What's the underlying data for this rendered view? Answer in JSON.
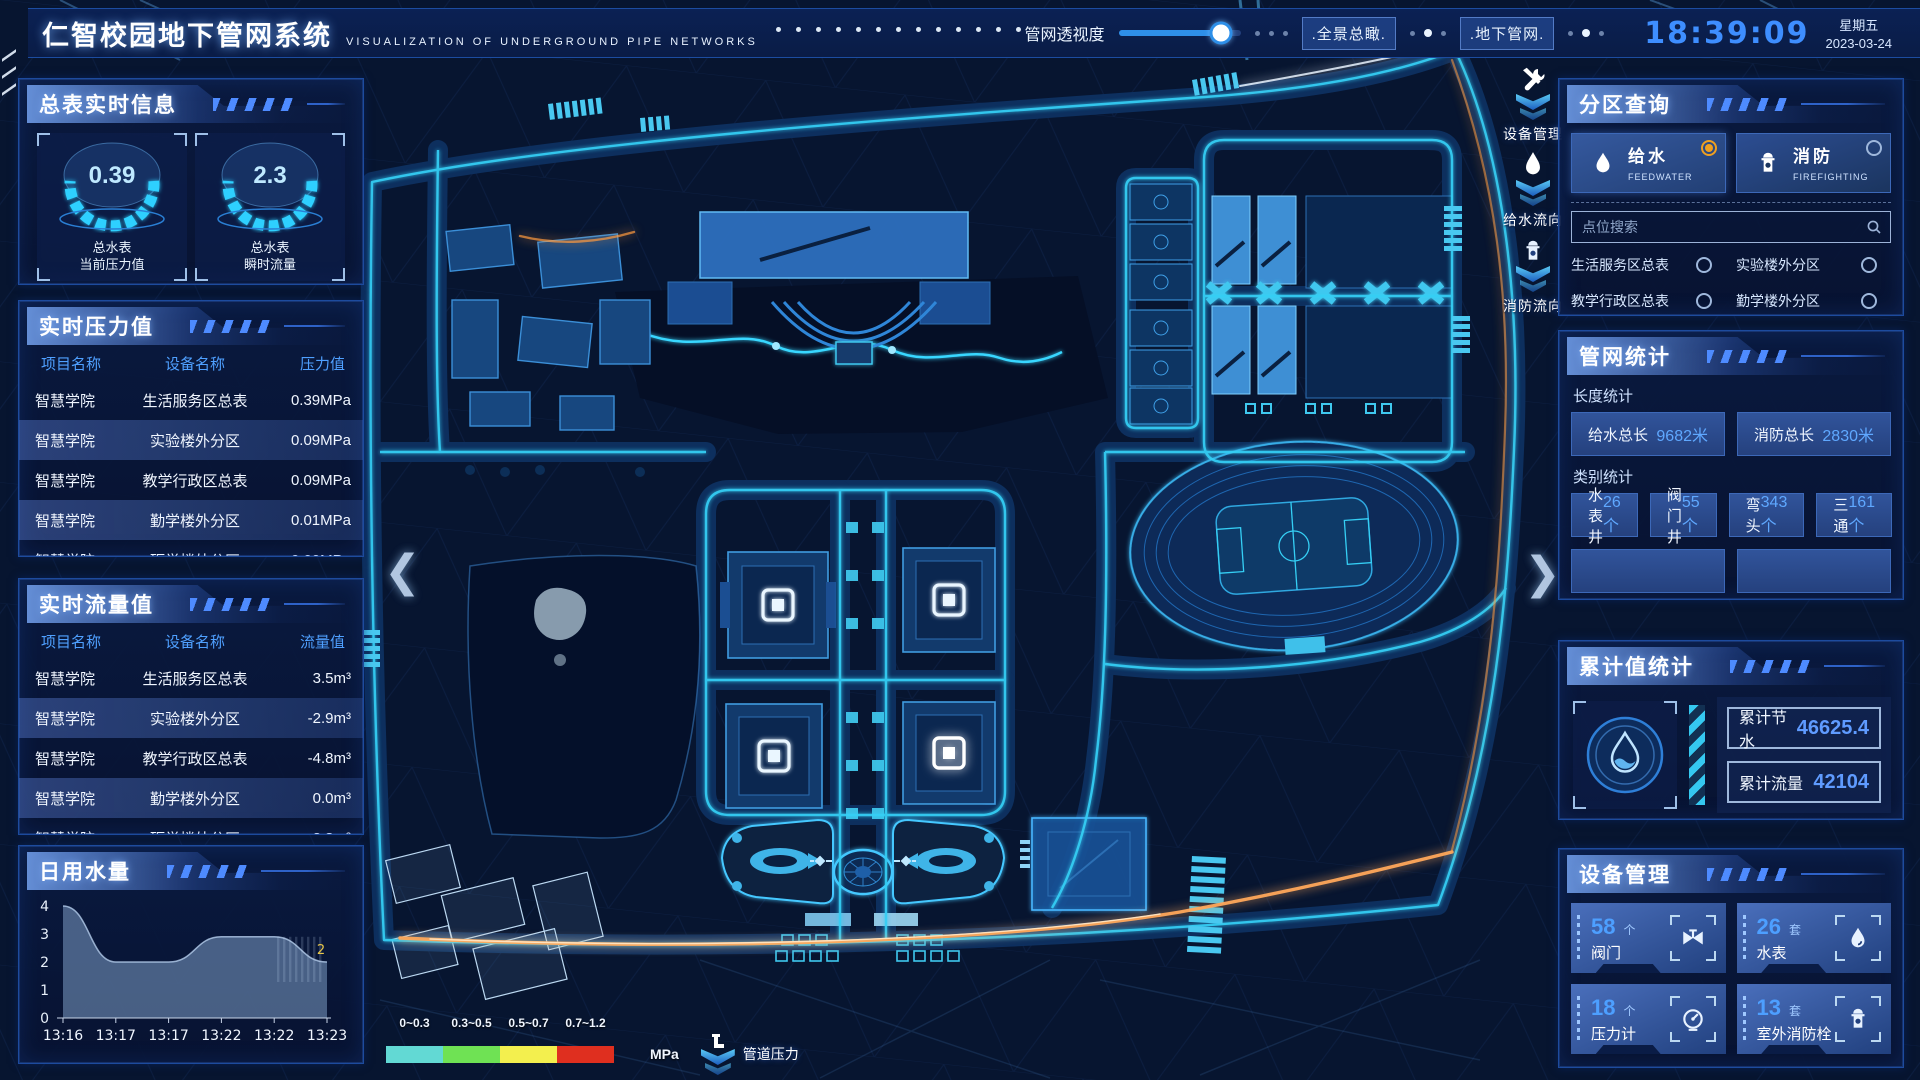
{
  "header": {
    "title": "仁智校园地下管网系统",
    "subtitle": "VISUALIZATION OF UNDERGROUND PIPE NETWORKS",
    "opacity_label": "管网透视度",
    "opacity_percent": 84,
    "btn_overview": ".全景总瞰.",
    "btn_underground": ".地下管网.",
    "time": "18:39:09",
    "weekday": "星期五",
    "date": "2023-03-24"
  },
  "left": {
    "meter_panel": {
      "title": "总表实时信息",
      "gauges": [
        {
          "value": "0.39",
          "label1": "总水表",
          "label2": "当前压力值"
        },
        {
          "value": "2.3",
          "label1": "总水表",
          "label2": "瞬时流量"
        }
      ]
    },
    "pressure_panel": {
      "title": "实时压力值",
      "headers": [
        "项目名称",
        "设备名称",
        "压力值"
      ],
      "rows": [
        [
          "智慧学院",
          "生活服务区总表",
          "0.39MPa"
        ],
        [
          "智慧学院",
          "实验楼外分区",
          "0.09MPa"
        ],
        [
          "智慧学院",
          "教学行政区总表",
          "0.09MPa"
        ],
        [
          "智慧学院",
          "勤学楼外分区",
          "0.01MPa"
        ],
        [
          "智慧学院",
          "砺学楼外分区",
          "0.00MPa"
        ]
      ]
    },
    "flow_panel": {
      "title": "实时流量值",
      "headers": [
        "项目名称",
        "设备名称",
        "流量值"
      ],
      "rows": [
        [
          "智慧学院",
          "生活服务区总表",
          "3.5m³"
        ],
        [
          "智慧学院",
          "实验楼外分区",
          "-2.9m³"
        ],
        [
          "智慧学院",
          "教学行政区总表",
          "-4.8m³"
        ],
        [
          "智慧学院",
          "勤学楼外分区",
          "0.0m³"
        ],
        [
          "智慧学院",
          "砺学楼外分区",
          "2.3m³"
        ]
      ]
    },
    "daily_panel": {
      "title": "日用水量"
    }
  },
  "chart_data": {
    "type": "area",
    "title": "日用水量",
    "x": [
      "13:16",
      "13:17",
      "13:17",
      "13:22",
      "13:22",
      "13:23"
    ],
    "values": [
      4,
      2,
      2,
      2.9,
      2.9,
      2
    ],
    "ylim": [
      0,
      4
    ],
    "yticks": [
      0,
      1,
      2,
      3,
      4
    ],
    "end_label": "2",
    "legend_position": "none",
    "grid": false
  },
  "map": {
    "overlay_tools": [
      {
        "label": "设备管理",
        "icon": "tools"
      },
      {
        "label": "给水流向",
        "icon": "water-drop"
      },
      {
        "label": "消防流向",
        "icon": "hydrant"
      }
    ],
    "legend": {
      "ranges": [
        "0~0.3",
        "0.3~0.5",
        "0.5~0.7",
        "0.7~1.2"
      ],
      "colors": [
        "#62d9d4",
        "#6fe254",
        "#f3ef4e",
        "#df2f1f"
      ],
      "unit": "MPa",
      "label": "管道压力"
    }
  },
  "right": {
    "query_panel": {
      "title": "分区查询",
      "modes": [
        {
          "label": "给水",
          "sub": "FEEDWATER",
          "icon": "water-drop",
          "selected": true
        },
        {
          "label": "消防",
          "sub": "FIREFIGHTING",
          "icon": "hydrant",
          "selected": false
        }
      ],
      "search_placeholder": "点位搜索",
      "options": [
        "生活服务区总表",
        "实验楼外分区",
        "教学行政区总表",
        "勤学楼外分区",
        "砺学楼外分区",
        "宿舍区泵房"
      ]
    },
    "stats_panel": {
      "title": "管网统计",
      "length_title": "长度统计",
      "length_stats": [
        {
          "label": "给水总长",
          "value": "9682米"
        },
        {
          "label": "消防总长",
          "value": "2830米"
        }
      ],
      "category_title": "类别统计",
      "category_stats": [
        {
          "label": "水表井",
          "value": "26个"
        },
        {
          "label": "阀门井",
          "value": "55个"
        },
        {
          "label": "弯头",
          "value": "343个"
        },
        {
          "label": "三通",
          "value": "161个"
        }
      ]
    },
    "cumulative_panel": {
      "title": "累计值统计",
      "items": [
        {
          "label": "累计节水",
          "value": "46625.4"
        },
        {
          "label": "累计流量",
          "value": "42104"
        }
      ]
    },
    "device_panel": {
      "title": "设备管理",
      "devices": [
        {
          "count": "58",
          "unit": "个",
          "label": "阀门",
          "icon": "valve"
        },
        {
          "count": "26",
          "unit": "套",
          "label": "水表",
          "icon": "water-meter"
        },
        {
          "count": "18",
          "unit": "个",
          "label": "压力计",
          "icon": "pressure-gauge"
        },
        {
          "count": "13",
          "unit": "套",
          "label": "室外消防栓",
          "icon": "hydrant"
        }
      ]
    }
  }
}
